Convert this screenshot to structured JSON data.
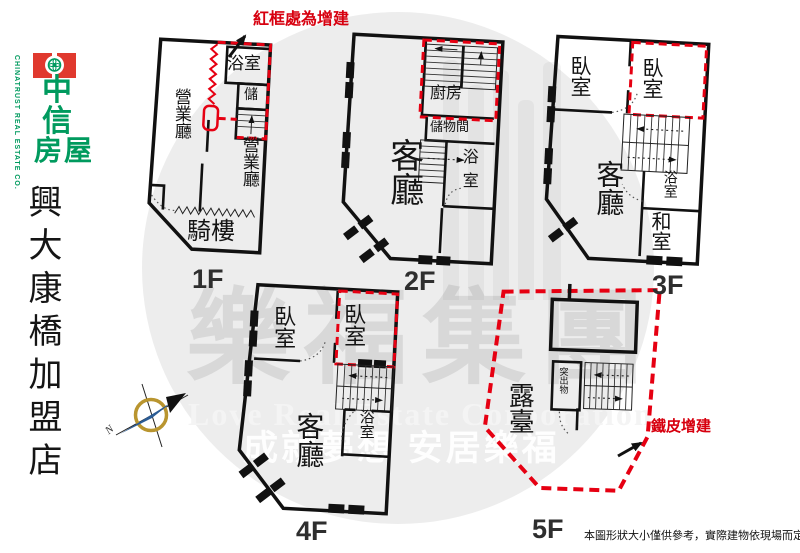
{
  "branding": {
    "brand_red": "#e0392e",
    "brand_green": "#009a5e",
    "logo_char_1": "中",
    "logo_char_2": "信",
    "logo_word": "房屋",
    "company_en": "CHINATRUST REAL ESTATE CO.",
    "store_name": "興大康橋加盟店"
  },
  "annotations": {
    "red_frame_note": "紅框處為增建",
    "metal_addition_note": "鐵皮增建",
    "disclaimer": "本圖形狀大小僅供參考，實際建物依現場而定。",
    "annotation_red": "#e60012"
  },
  "compass": {
    "north_label": "N"
  },
  "watermark": {
    "group_name": "樂福集團",
    "group_name_en": "Love Real Estate Corporation",
    "tagline": "成就夢想 安居樂福"
  },
  "floors": {
    "f1": {
      "label": "1F",
      "hall_left": "營業廳",
      "hall_right": "營業廳",
      "bath": "浴室",
      "storage": "儲",
      "arcade": "騎樓"
    },
    "f2": {
      "label": "2F",
      "living": "客廳",
      "kitchen": "廚房",
      "storage": "儲物間",
      "bath": "浴室"
    },
    "f3": {
      "label": "3F",
      "bed_left": "臥室",
      "bed_right": "臥室",
      "living": "客廳",
      "bath": "浴室",
      "tatami": "和室"
    },
    "f4": {
      "label": "4F",
      "bed_left": "臥室",
      "bed_right": "臥室",
      "living": "客廳",
      "bath": "浴室"
    },
    "f5": {
      "label": "5F",
      "terrace": "露臺",
      "protrusion": "突出物"
    }
  }
}
